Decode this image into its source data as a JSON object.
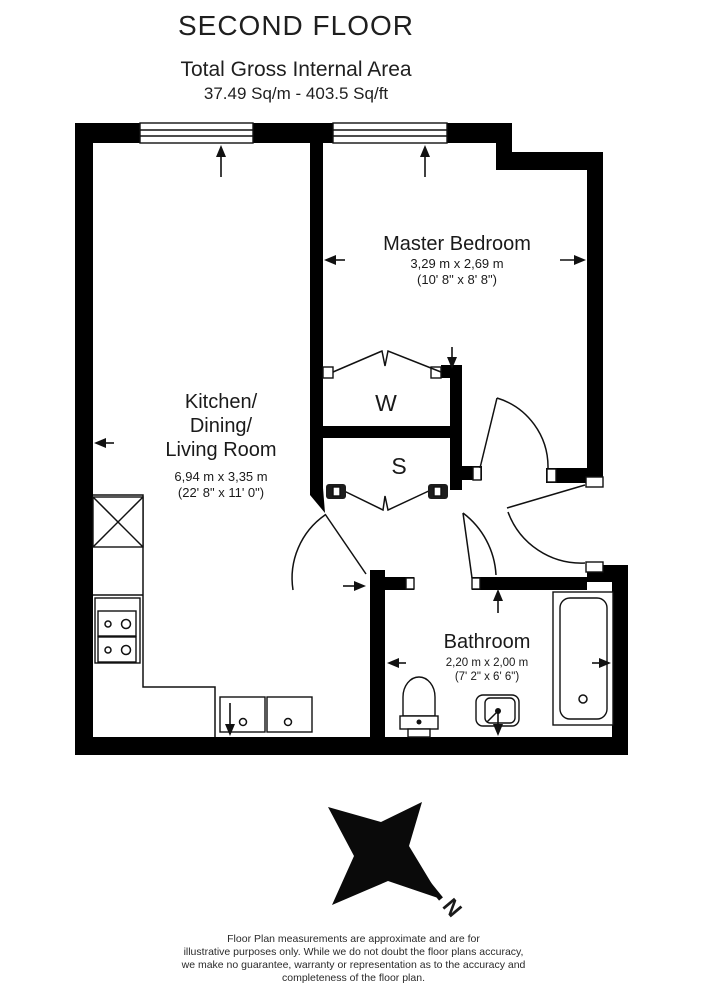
{
  "header": {
    "title": "SECOND FLOOR",
    "subtitle": "Total Gross Internal Area",
    "area": "37.49 Sq/m - 403.5 Sq/ft"
  },
  "rooms": {
    "master_bedroom": {
      "name": "Master Bedroom",
      "metric": "3,29 m x 2,69 m",
      "imperial": "(10' 8\" x 8' 8\")"
    },
    "kitchen": {
      "name_line1": "Kitchen/",
      "name_line2": "Dining/",
      "name_line3": "Living Room",
      "metric": "6,94 m x 3,35 m",
      "imperial": "(22' 8\" x 11' 0\")"
    },
    "bathroom": {
      "name": "Bathroom",
      "metric": "2,20 m x 2,00 m",
      "imperial": "(7' 2\" x 6' 6\")"
    },
    "wardrobe": {
      "label": "W"
    },
    "storage": {
      "label": "S"
    }
  },
  "compass": {
    "north_label": "N"
  },
  "footer": {
    "line1": "Floor Plan measurements are approximate and are for",
    "line2": "illustrative purposes only.  While we do not doubt the floor plans accuracy,",
    "line3": "we make no guarantee, warranty or representation as to the accuracy and",
    "line4": "completeness of the floor plan.",
    "colors": {
      "wall": "#000000",
      "background": "#ffffff",
      "text": "#1a1a1a"
    }
  }
}
